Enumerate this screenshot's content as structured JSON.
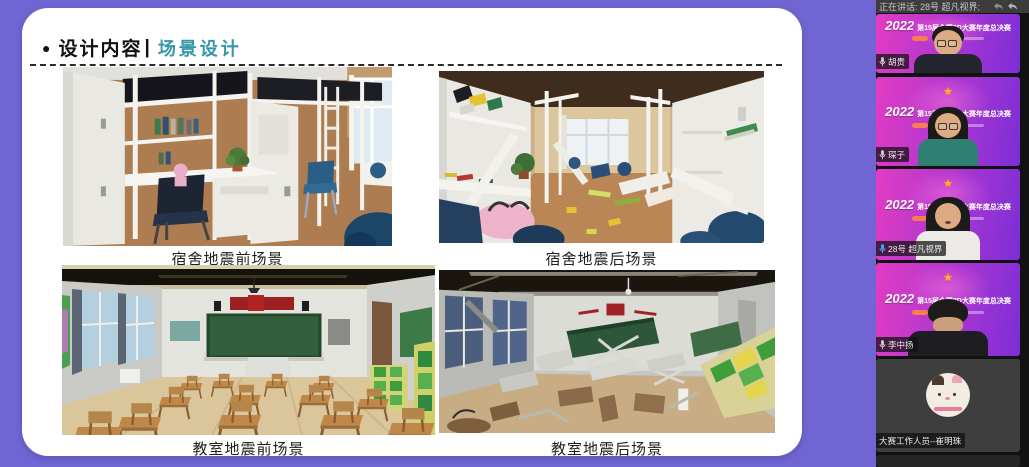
{
  "colors": {
    "background_purple": "#7165d4",
    "accent_teal": "#3697a8",
    "banner_magenta": "#e23cc2",
    "banner_purple": "#7c2ed6",
    "speaking_mic_blue": "#4da3ff",
    "status_bar_gray": "#3c3c3c"
  },
  "slide": {
    "bullet": "●",
    "title_main": "设计内容",
    "title_separator": "|",
    "title_sub": "场景设计",
    "images": [
      {
        "name": "dorm-before",
        "caption": "宿舍地震前场景"
      },
      {
        "name": "dorm-after",
        "caption": "宿舍地震后场景"
      },
      {
        "name": "classroom-before",
        "caption": "教室地震前场景"
      },
      {
        "name": "classroom-after",
        "caption": "教室地震后场景"
      }
    ]
  },
  "meeting": {
    "status_bar": {
      "speaking_label": "正在讲话: 28号 超凡视界;",
      "icons": [
        "undo-arrow-icon",
        "reply-arrow-icon"
      ]
    },
    "banner": {
      "year": "2022",
      "title": "第15届全国3D大赛年度总决赛",
      "trophy_icon": "★"
    },
    "participants": [
      {
        "name": "胡贵",
        "has_banner": true,
        "speaking": false
      },
      {
        "name": "琛子",
        "has_banner": true,
        "speaking": false
      },
      {
        "name": "28号 超凡视界",
        "has_banner": true,
        "speaking": true
      },
      {
        "name": "李中扬",
        "has_banner": true,
        "speaking": false
      },
      {
        "name": "大赛工作人员--崔明珠",
        "has_banner": false,
        "speaking": false
      }
    ]
  }
}
